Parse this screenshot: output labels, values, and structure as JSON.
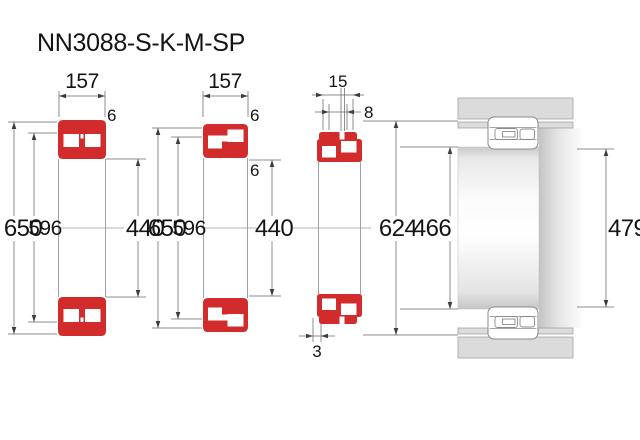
{
  "title": "NN3088-S-K-M-SP",
  "colors": {
    "bearing_red": "#d22b2b",
    "housing_gray": "#dbdbdb",
    "dimension_line": "#6a6a6a"
  },
  "view1": {
    "width": "157",
    "outer_ring_width": "6",
    "outer_diameter": "650",
    "rib_diameter": "596",
    "bore_diameter": "440"
  },
  "view2": {
    "width": "157",
    "outer_ring_width": "6",
    "inner_ring_width": "6",
    "outer_diameter": "650",
    "rib_diameter": "596",
    "bore_diameter": "440"
  },
  "view3": {
    "cage_width": "15",
    "groove_width": "8",
    "edge_offset": "3",
    "outer_diameter": "624",
    "inner_diameter": "466"
  },
  "mounting": {
    "shaft_abutment_diameter": "479"
  }
}
